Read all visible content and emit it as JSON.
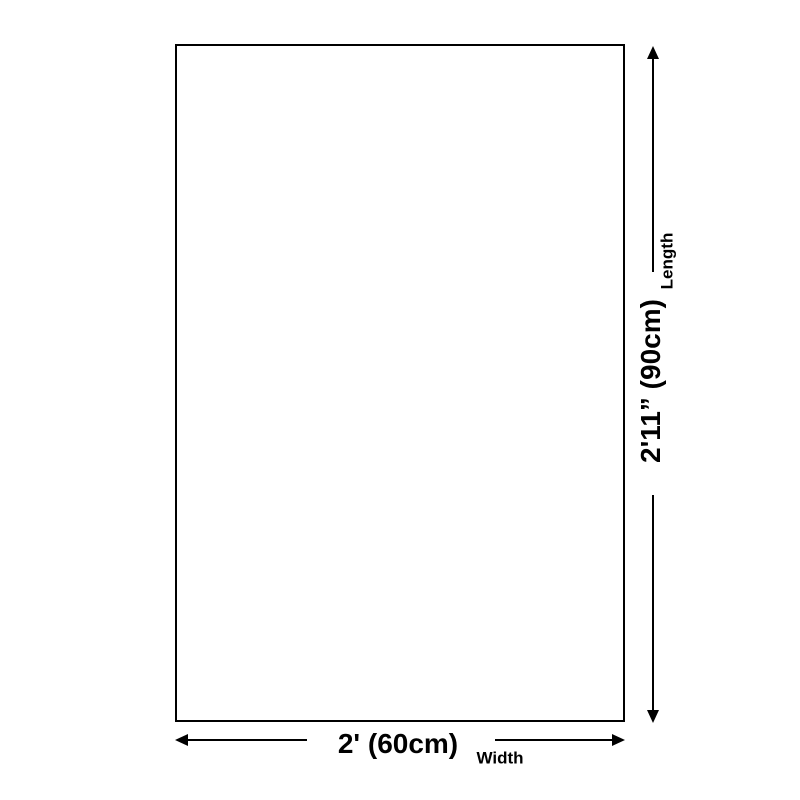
{
  "diagram": {
    "title": "product-dimensions-diagram",
    "length_dimension": {
      "value": "2'11” (90cm)",
      "label": "Length"
    },
    "width_dimension": {
      "value": "2' (60cm)",
      "label": "Width"
    },
    "colors": {
      "line": "#000000",
      "background": "#ffffff"
    }
  }
}
